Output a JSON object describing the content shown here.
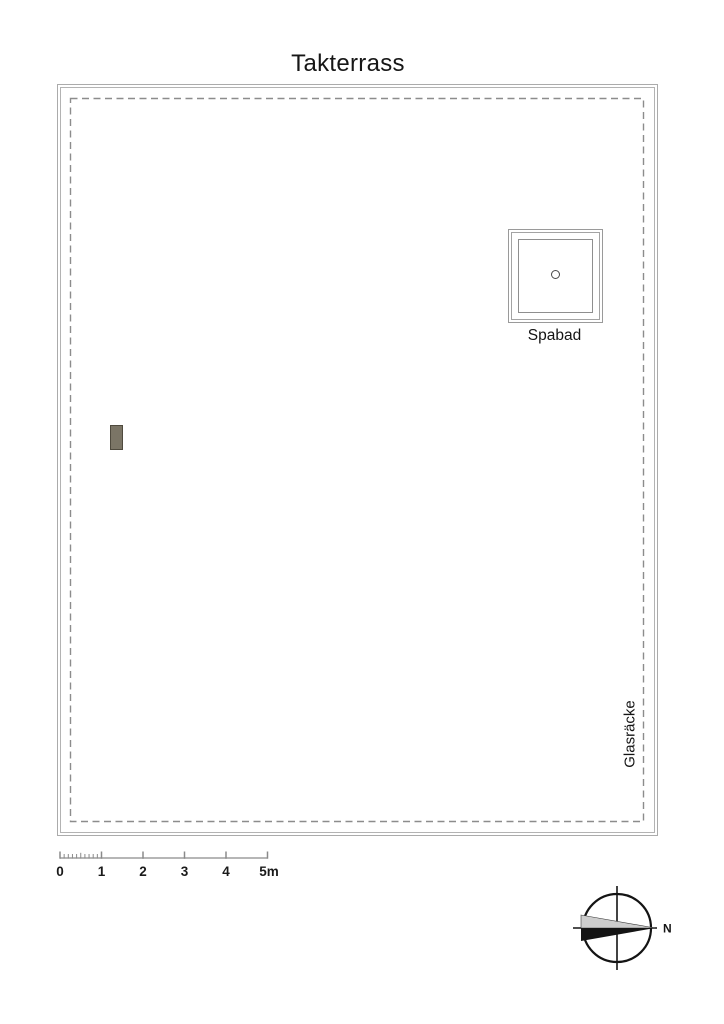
{
  "title": "Takterrass",
  "plan": {
    "spa_label": "Spabad",
    "railing_label": "Glasräcke"
  },
  "scale_bar": {
    "unit_labels": [
      "0",
      "1",
      "2",
      "3",
      "4",
      "5m"
    ],
    "meters_total": 5,
    "minor_divisions_first_meter": 10
  },
  "compass": {
    "north_label": "N",
    "north_direction": "right"
  },
  "colors": {
    "boundary_line": "#ababab",
    "dashed_outline": "#8c8c8c",
    "spa_line": "#9a9a9a",
    "drain_fill": "#7b7566",
    "drain_border": "#4f4a3e",
    "scale_line": "#9e9e9e",
    "compass_line": "#141414",
    "needle_gray": "#cdcdcd",
    "needle_black": "#141414",
    "text": "#141414",
    "background": "#ffffff"
  }
}
